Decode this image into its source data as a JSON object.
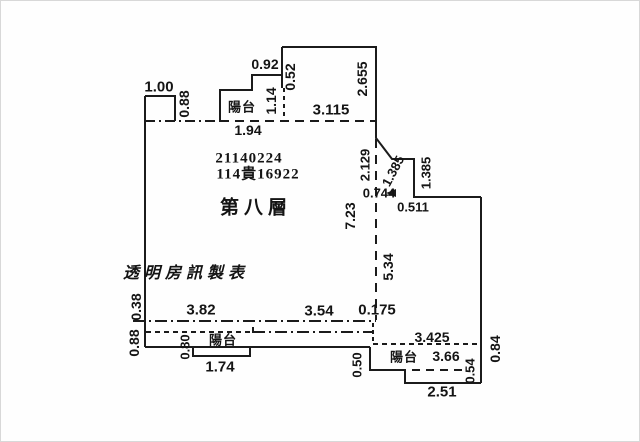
{
  "meta": {
    "background_color": "#fefefe",
    "line_color": "#1b1b1b",
    "unit_hint": "meters"
  },
  "document": {
    "serial_number": "21140224",
    "case_number": "114貴16922",
    "floor_label": "第八層",
    "watermark": "透明房訊製表",
    "balcony_word": "陽台"
  },
  "labels": [
    {
      "id": "dim-1.00-top-left",
      "text": "1.00",
      "x": 159,
      "y": 87,
      "rot": 0,
      "font": "sans",
      "size": 15,
      "ls": 0
    },
    {
      "id": "dim-0.88-top-left",
      "text": "0.88",
      "x": 184,
      "y": 104,
      "rot": -90,
      "font": "sans",
      "size": 14,
      "ls": 0
    },
    {
      "id": "dim-0.92-top",
      "text": "0.92",
      "x": 265,
      "y": 64,
      "rot": 0,
      "font": "sans",
      "size": 14,
      "ls": 0
    },
    {
      "id": "dim-0.52-top",
      "text": "0.52",
      "x": 290,
      "y": 77,
      "rot": -90,
      "font": "sans",
      "size": 14,
      "ls": 0
    },
    {
      "id": "balcony-label-top",
      "text": "陽台",
      "x": 242,
      "y": 107,
      "rot": 0,
      "font": "sans",
      "size": 13,
      "ls": 1
    },
    {
      "id": "dim-1.14-top",
      "text": "1.14",
      "x": 271,
      "y": 101,
      "rot": -90,
      "font": "sans",
      "size": 14,
      "ls": 0
    },
    {
      "id": "dim-1.94-top",
      "text": "1.94",
      "x": 248,
      "y": 130,
      "rot": 0,
      "font": "sans",
      "size": 14,
      "ls": 0
    },
    {
      "id": "dim-3.115-top",
      "text": "3.115",
      "x": 331,
      "y": 110,
      "rot": 0,
      "font": "sans",
      "size": 15,
      "ls": 0
    },
    {
      "id": "dim-2.655-right",
      "text": "2.655",
      "x": 362,
      "y": 79,
      "rot": -90,
      "font": "sans",
      "size": 14,
      "ls": 0
    },
    {
      "id": "serial-number",
      "text": "21140224",
      "x": 249,
      "y": 159,
      "rot": 0,
      "font": "serif",
      "size": 15,
      "ls": 1
    },
    {
      "id": "case-number",
      "text": "114貴16922",
      "x": 258,
      "y": 175,
      "rot": 0,
      "font": "serif",
      "size": 15,
      "ls": 1
    },
    {
      "id": "floor-label",
      "text": "第八層",
      "x": 256,
      "y": 208,
      "rot": 0,
      "font": "sans",
      "size": 19,
      "ls": 5
    },
    {
      "id": "dim-2.129-right",
      "text": "2.129",
      "x": 365,
      "y": 165,
      "rot": -90,
      "font": "sans",
      "size": 13,
      "ls": 0
    },
    {
      "id": "dim-1.385-diagonal",
      "text": "1.385",
      "x": 393,
      "y": 171,
      "rot": -62,
      "font": "sans",
      "size": 13,
      "ls": 0
    },
    {
      "id": "dim-1.385-vertical",
      "text": "1.385",
      "x": 426,
      "y": 173,
      "rot": -90,
      "font": "sans",
      "size": 13,
      "ls": 0
    },
    {
      "id": "dim-0.744-right",
      "text": "0.744",
      "x": 379,
      "y": 193,
      "rot": 0,
      "font": "sans",
      "size": 13,
      "ls": 0
    },
    {
      "id": "dim-0.511-right",
      "text": "0.511",
      "x": 413,
      "y": 207,
      "rot": 0,
      "font": "sans",
      "size": 13,
      "ls": 0
    },
    {
      "id": "dim-7.23-middle",
      "text": "7.23",
      "x": 350,
      "y": 216,
      "rot": -90,
      "font": "sans",
      "size": 14,
      "ls": 0
    },
    {
      "id": "dim-5.34-middle",
      "text": "5.34",
      "x": 388,
      "y": 267,
      "rot": -90,
      "font": "sans",
      "size": 14,
      "ls": 0
    },
    {
      "id": "watermark",
      "text": "透明房訊製表",
      "x": 186,
      "y": 274,
      "rot": 0,
      "font": "kai",
      "size": 16,
      "ls": 5
    },
    {
      "id": "dim-0.38-left",
      "text": "0.38",
      "x": 136,
      "y": 307,
      "rot": -90,
      "font": "sans",
      "size": 14,
      "ls": 0
    },
    {
      "id": "dim-0.88-left-bottom",
      "text": "0.88",
      "x": 134,
      "y": 343,
      "rot": -90,
      "font": "sans",
      "size": 14,
      "ls": 0
    },
    {
      "id": "dim-3.82-bottom",
      "text": "3.82",
      "x": 201,
      "y": 310,
      "rot": 0,
      "font": "sans",
      "size": 15,
      "ls": 0
    },
    {
      "id": "dim-3.54-bottom",
      "text": "3.54",
      "x": 319,
      "y": 311,
      "rot": 0,
      "font": "sans",
      "size": 15,
      "ls": 0
    },
    {
      "id": "dim-0.175-bottom",
      "text": "0.175",
      "x": 377,
      "y": 310,
      "rot": 0,
      "font": "sans",
      "size": 15,
      "ls": 0
    },
    {
      "id": "dim-0.80-bottom-left",
      "text": "0.80",
      "x": 185,
      "y": 347,
      "rot": -90,
      "font": "sans",
      "size": 13,
      "ls": 0
    },
    {
      "id": "balcony-label-bottom-left",
      "text": "陽台",
      "x": 223,
      "y": 340,
      "rot": 0,
      "font": "sans",
      "size": 13,
      "ls": 1
    },
    {
      "id": "dim-1.74-bottom-left",
      "text": "1.74",
      "x": 220,
      "y": 367,
      "rot": 0,
      "font": "sans",
      "size": 15,
      "ls": 0
    },
    {
      "id": "dim-0.50-bottom",
      "text": "0.50",
      "x": 357,
      "y": 365,
      "rot": -90,
      "font": "sans",
      "size": 13,
      "ls": 0
    },
    {
      "id": "dim-3.425-bottom-right",
      "text": "3.425",
      "x": 432,
      "y": 337,
      "rot": 0,
      "font": "sans",
      "size": 14,
      "ls": 0
    },
    {
      "id": "balcony-label-bottom-right",
      "text": "陽台",
      "x": 404,
      "y": 357,
      "rot": 0,
      "font": "sans",
      "size": 13,
      "ls": 1
    },
    {
      "id": "dim-3.66-bottom-right",
      "text": "3.66",
      "x": 446,
      "y": 356,
      "rot": 0,
      "font": "sans",
      "size": 14,
      "ls": 0
    },
    {
      "id": "dim-0.54-bottom-right",
      "text": "0.54",
      "x": 470,
      "y": 371,
      "rot": -90,
      "font": "sans",
      "size": 13,
      "ls": 0
    },
    {
      "id": "dim-2.51-bottom-right",
      "text": "2.51",
      "x": 442,
      "y": 392,
      "rot": 0,
      "font": "sans",
      "size": 15,
      "ls": 0
    },
    {
      "id": "dim-0.84-right",
      "text": "0.84",
      "x": 495,
      "y": 349,
      "rot": -90,
      "font": "sans",
      "size": 14,
      "ls": 0
    }
  ]
}
